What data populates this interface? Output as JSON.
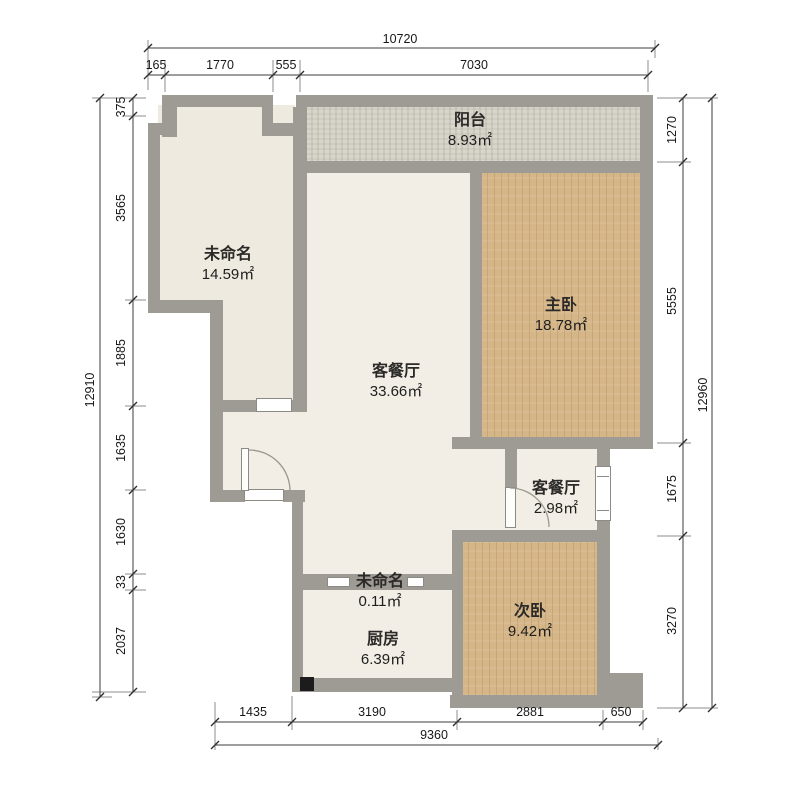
{
  "plan": {
    "rooms": [
      {
        "name": "阳台",
        "area": "8.93㎡"
      },
      {
        "name": "未命名",
        "area": "14.59㎡"
      },
      {
        "name": "主卧",
        "area": "18.78㎡"
      },
      {
        "name": "客餐厅",
        "area": "33.66㎡"
      },
      {
        "name": "客餐厅",
        "area": "2.98㎡"
      },
      {
        "name": "次卧",
        "area": "9.42㎡"
      },
      {
        "name": "未命名",
        "area": "0.11㎡"
      },
      {
        "name": "厨房",
        "area": "6.39㎡"
      }
    ],
    "dimensions_mm": {
      "top": {
        "total": "10720",
        "segments": [
          "165",
          "1770",
          "555",
          "7030"
        ]
      },
      "left": {
        "total": "12910",
        "segments": [
          "375",
          "3565",
          "1885",
          "1635",
          "1630",
          "33",
          "2037"
        ]
      },
      "right": {
        "total": "12960",
        "segments": [
          "1270",
          "5555",
          "1675",
          "3270"
        ]
      },
      "bottom": {
        "total": "9360",
        "segments": [
          "1435",
          "3190",
          "2881",
          "650"
        ]
      }
    },
    "colors": {
      "wall": "#9e9b94",
      "wood_floor": "#d5b688",
      "tile_floor": "#f2eee5",
      "balcony_floor": "#d8d5cb"
    }
  }
}
